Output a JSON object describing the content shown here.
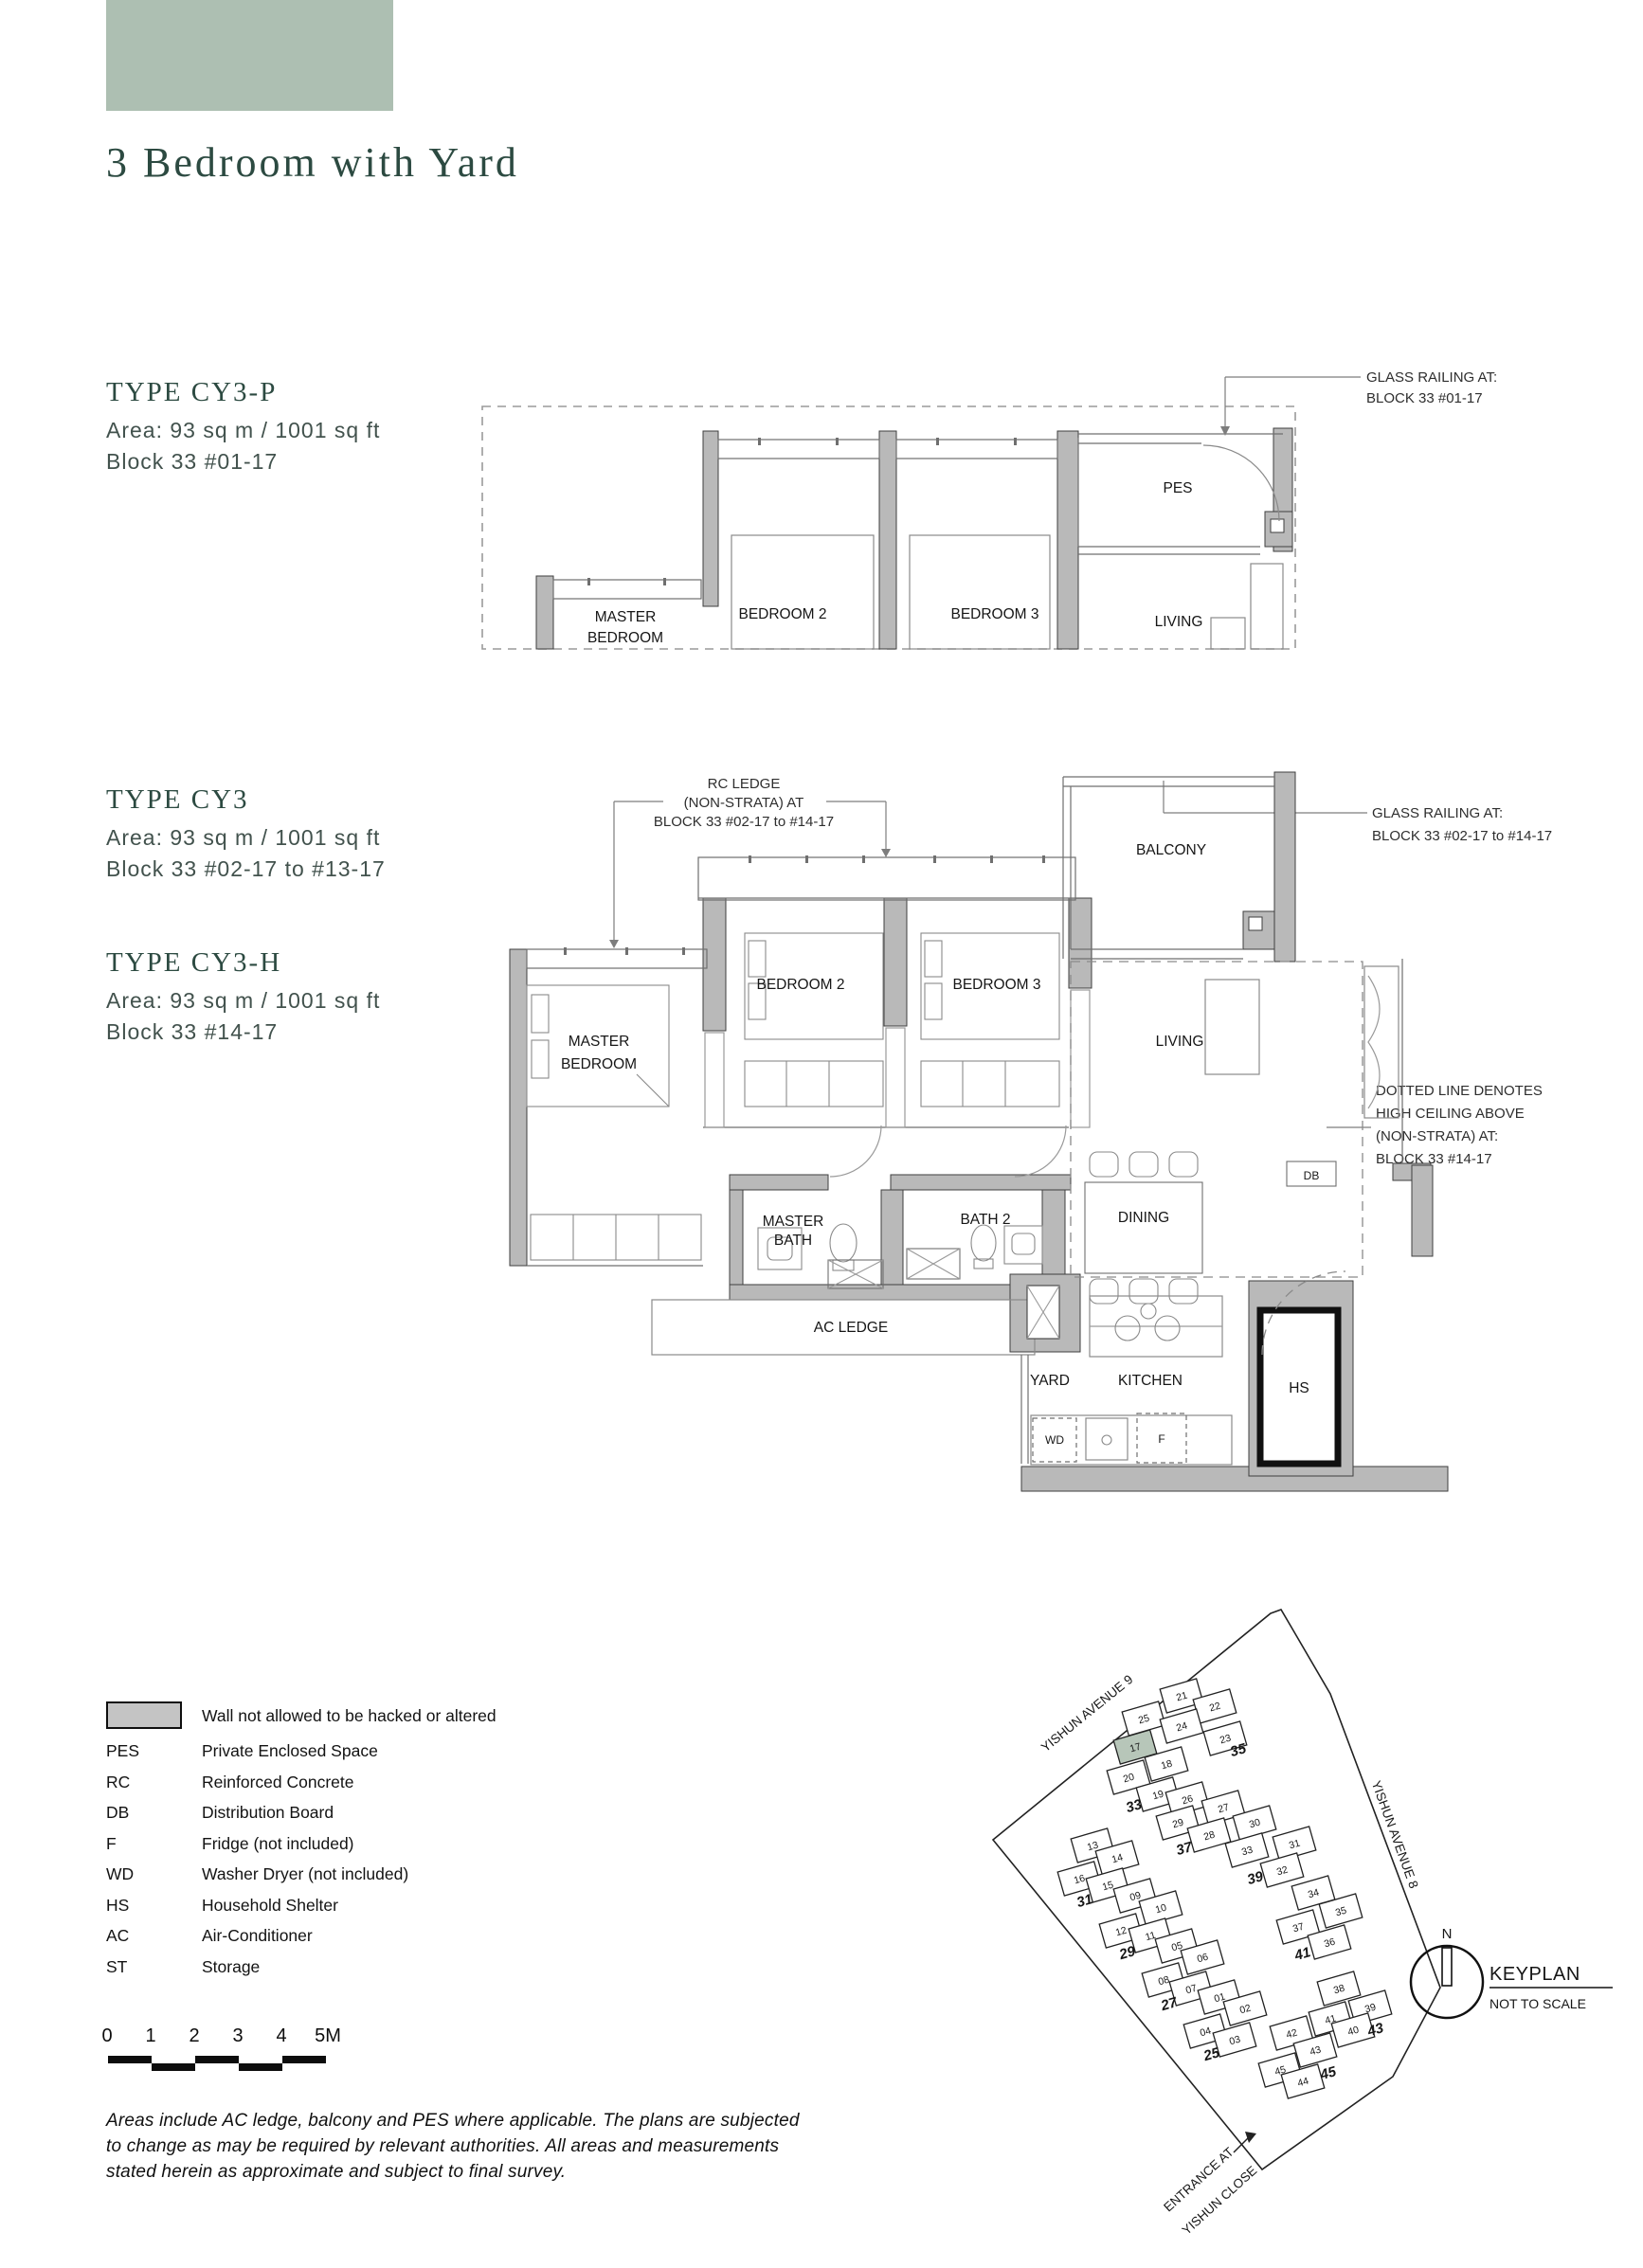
{
  "page": {
    "title": "3 Bedroom with Yard"
  },
  "types": [
    {
      "name": "TYPE CY3-P",
      "area": "Area: 93 sq m / 1001 sq ft",
      "block": "Block 33 #01-17"
    },
    {
      "name": "TYPE CY3",
      "area": "Area: 93 sq m / 1001 sq ft",
      "block": "Block 33 #02-17 to #13-17"
    },
    {
      "name": "TYPE CY3-H",
      "area": "Area: 93 sq m / 1001 sq ft",
      "block": "Block 33 #14-17"
    }
  ],
  "plan_top": {
    "rooms": {
      "master_l1": "MASTER",
      "master_l2": "BEDROOM",
      "bedroom2": "BEDROOM 2",
      "bedroom3": "BEDROOM 3",
      "living": "LIVING",
      "pes": "PES"
    },
    "glass_note": [
      "GLASS RAILING AT:",
      "BLOCK 33 #01-17"
    ]
  },
  "plan_main": {
    "rooms": {
      "master_l1": "MASTER",
      "master_l2": "BEDROOM",
      "bedroom2": "BEDROOM 2",
      "bedroom3": "BEDROOM 3",
      "living": "LIVING",
      "balcony": "BALCONY",
      "master_bath_l1": "MASTER",
      "master_bath_l2": "BATH",
      "bath2": "BATH 2",
      "dining": "DINING",
      "db": "DB",
      "ac_ledge": "AC LEDGE",
      "yard": "YARD",
      "kitchen": "KITCHEN",
      "hs": "HS",
      "wd": "WD",
      "f": "F"
    },
    "rc_note": [
      "RC LEDGE",
      "(NON-STRATA) AT",
      "BLOCK 33 #02-17 to #14-17"
    ],
    "glass_note": [
      "GLASS RAILING AT:",
      "BLOCK 33 #02-17 to #14-17"
    ],
    "ceiling_note": [
      "DOTTED LINE DENOTES",
      "HIGH CEILING ABOVE",
      "(NON-STRATA) AT:",
      "BLOCK 33 #14-17"
    ]
  },
  "legend": {
    "wall_label": "Wall not allowed to be hacked or altered",
    "items": [
      {
        "abbr": "PES",
        "label": "Private Enclosed Space"
      },
      {
        "abbr": "RC",
        "label": "Reinforced Concrete"
      },
      {
        "abbr": "DB",
        "label": "Distribution Board"
      },
      {
        "abbr": "F",
        "label": "Fridge (not included)"
      },
      {
        "abbr": "WD",
        "label": "Washer Dryer (not included)"
      },
      {
        "abbr": "HS",
        "label": "Household Shelter"
      },
      {
        "abbr": "AC",
        "label": "Air-Conditioner"
      },
      {
        "abbr": "ST",
        "label": "Storage"
      }
    ]
  },
  "scalebar": {
    "ticks": [
      "0",
      "1",
      "2",
      "3",
      "4",
      "5M"
    ]
  },
  "disclaimer": "Areas include AC ledge, balcony and PES where applicable. The plans are subjected to change as may be required by relevant authorities. All areas and measurements stated herein as approximate and subject to final survey.",
  "keyplan": {
    "title": "KEYPLAN",
    "subtitle": "NOT TO SCALE",
    "north": "N",
    "street1": "YISHUN AVENUE 9",
    "street2": "YISHUN AVENUE 8",
    "entrance_l1": "ENTRANCE AT",
    "entrance_l2": "YISHUN CLOSE",
    "highlighted": {
      "block": "33",
      "unit": "17"
    },
    "highlight_color": "#b7c6b9",
    "clusters": [
      {
        "block": "35",
        "units": [
          "21",
          "22",
          "25",
          "24",
          "23"
        ]
      },
      {
        "block": "33",
        "units": [
          "17",
          "18",
          "20",
          "19"
        ]
      },
      {
        "block": "37",
        "units": [
          "26",
          "27",
          "29",
          "28"
        ]
      },
      {
        "block": "39",
        "units": [
          "30",
          "31",
          "33",
          "32"
        ]
      },
      {
        "block": "31",
        "units": [
          "13",
          "14",
          "16",
          "15"
        ]
      },
      {
        "block": "29",
        "units": [
          "09",
          "10",
          "12",
          "11"
        ]
      },
      {
        "block": "41",
        "units": [
          "34",
          "35",
          "37",
          "36"
        ]
      },
      {
        "block": "27",
        "units": [
          "05",
          "06",
          "08",
          "07"
        ]
      },
      {
        "block": "25",
        "units": [
          "01",
          "02",
          "04",
          "03"
        ]
      },
      {
        "block": "43",
        "units": [
          "38",
          "39",
          "41",
          "40"
        ]
      },
      {
        "block": "45",
        "units": [
          "42",
          "43",
          "45",
          "44"
        ]
      }
    ]
  },
  "colors": {
    "accent": "#adbfb2",
    "heading": "#2c4a41",
    "wall_gray": "#b9b9b9"
  }
}
